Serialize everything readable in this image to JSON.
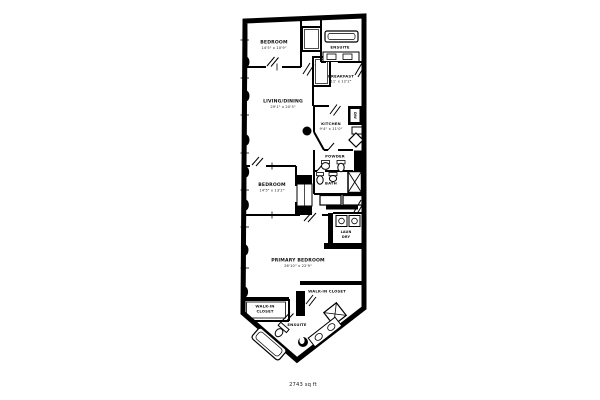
{
  "page": {
    "background": "#ffffff",
    "area_note": "2743 sq ft"
  },
  "rooms": {
    "bedroom_top": {
      "name": "BEDROOM",
      "dims": "14'5\" x 10'9\""
    },
    "ensuite_top": {
      "name": "ENSUITE"
    },
    "breakfast": {
      "name": "BREAKFAST",
      "dims": "11' x 12'2\""
    },
    "living_dining": {
      "name": "LIVING/DINING",
      "dims": "29'1\" x 20'3\""
    },
    "kitchen": {
      "name": "KITCHEN",
      "dims": "9'4\" x 11'0\""
    },
    "powder": {
      "name": "POWDER"
    },
    "bath": {
      "name": "BATH"
    },
    "bedroom_mid": {
      "name": "BEDROOM",
      "dims": "14'5\" x 13'2\""
    },
    "laundry": {
      "line1": "LAUN",
      "line2": "DRY"
    },
    "primary_bedroom": {
      "name": "PRIMARY BEDROOM",
      "dims": "26'10\" x 22'9\""
    },
    "walkin_right": {
      "name": "WALK-IN CLOSET"
    },
    "walkin_left": {
      "line1": "WALK-IN",
      "line2": "CLOSET"
    },
    "ensuite_bottom": {
      "name": "ENSUITE"
    },
    "appliances": {
      "dishwasher": "DW"
    }
  },
  "colors": {
    "wall": "#000000",
    "text": "#111111",
    "background": "#ffffff"
  }
}
